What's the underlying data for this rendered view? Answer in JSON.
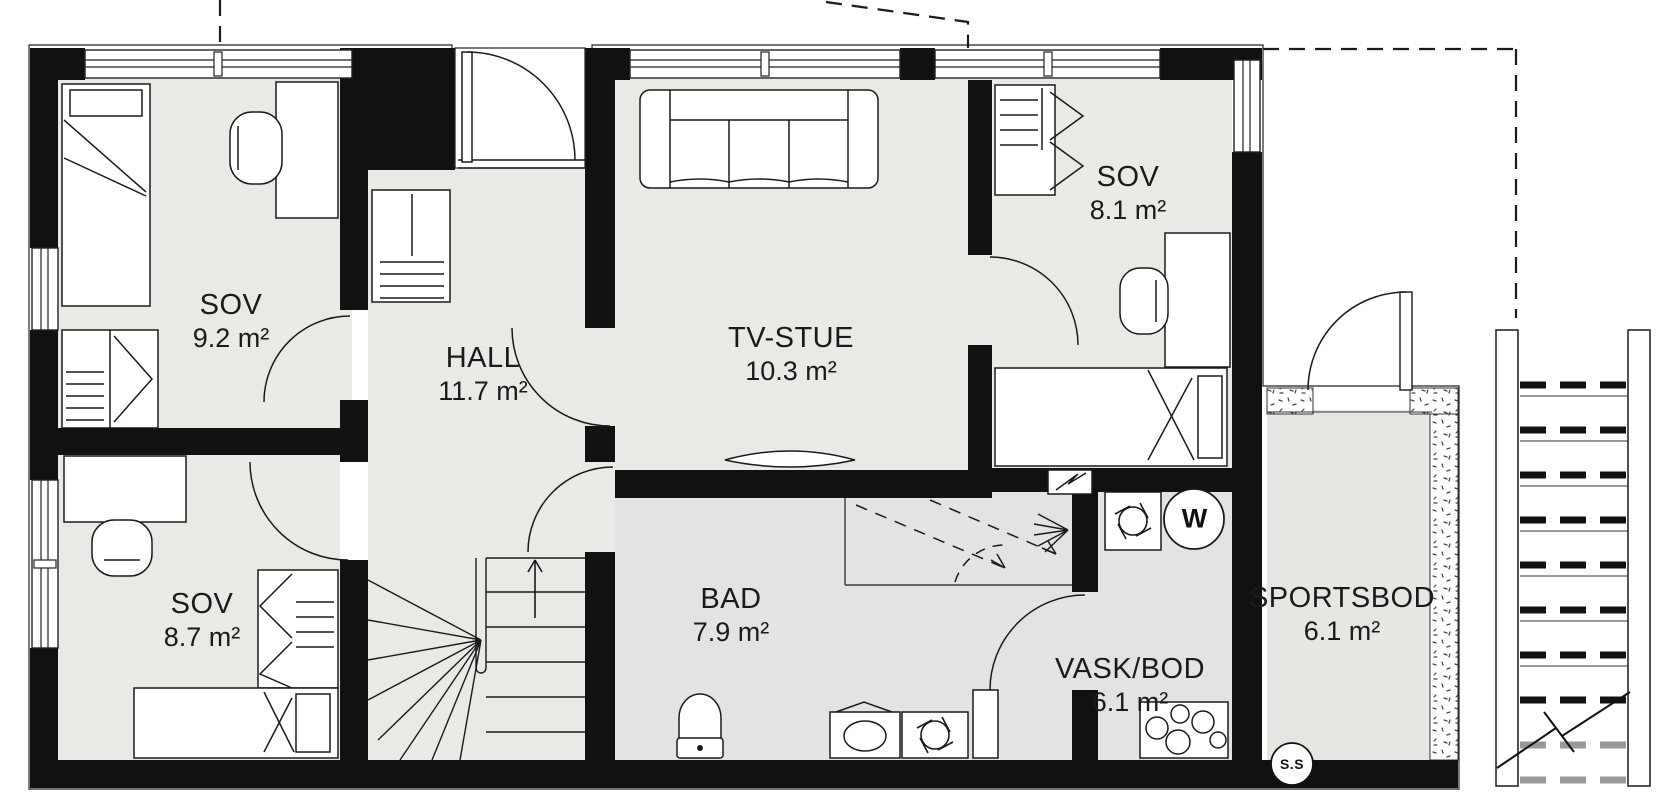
{
  "plan": {
    "type": "floor-plan",
    "language": "Norwegian",
    "rooms": [
      {
        "id": "sov-1",
        "name": "SOV",
        "area": "9.2 m²"
      },
      {
        "id": "hall",
        "name": "HALL",
        "area": "11.7 m²"
      },
      {
        "id": "tv-stue",
        "name": "TV-STUE",
        "area": "10.3 m²"
      },
      {
        "id": "sov-2",
        "name": "SOV",
        "area": "8.1 m²"
      },
      {
        "id": "sov-3",
        "name": "SOV",
        "area": "8.7 m²"
      },
      {
        "id": "bad",
        "name": "BAD",
        "area": "7.9 m²"
      },
      {
        "id": "vask-bod",
        "name": "VASK/BOD",
        "area": "6.1 m²"
      },
      {
        "id": "sportsbod",
        "name": "SPORTSBOD",
        "area": "6.1 m²"
      }
    ],
    "symbols": {
      "water_heater": "W",
      "floor_drain": "S.S"
    },
    "colors": {
      "wall": "#111111",
      "floor_main": "#ebe9e6",
      "floor_wet": "#e3e3e3",
      "floor_storage": "#e8e6e2",
      "line": "#1a1a1a"
    }
  }
}
